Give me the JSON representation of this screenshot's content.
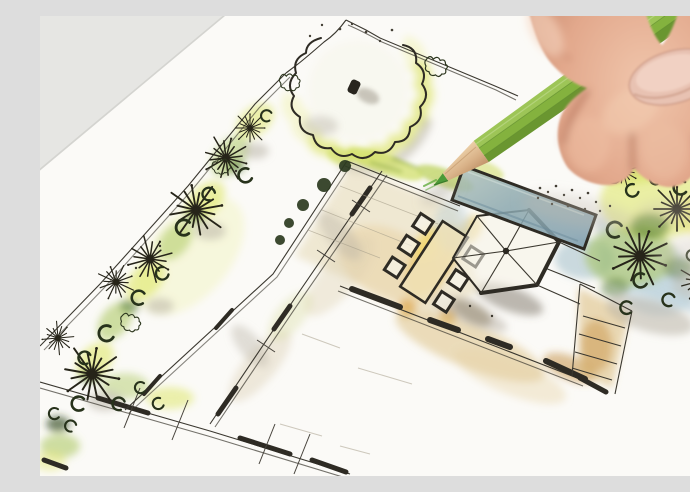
{
  "image": {
    "description": "Close-up photograph of a landscape architect's hand holding a green colored pencil over a hand-sketched garden landscape plan with ink lines and watercolor washes",
    "scene": "garden-plan-sketch-with-hand-and-pencil",
    "objects": {
      "plan_sheet": "white drawing paper with garden plan rotated diagonally",
      "tree_canopy": "large scalloped round tree crown with dark trunk dot",
      "left_planting_strip": "diagonal planting bed with starburst plants and shrub scribbles",
      "dining_terrace": "beige paved terrace with rectangular table and six chairs",
      "pavilion": "hexagonal pavilion roof with radial spokes",
      "pool": "rectangular water basin with teal-blue wash",
      "right_planting_bed": "dense planting with starburst trees, crescents and blue water wash",
      "paths_walls": "double-line garden walls with thick wall segments, tick marks and stepped walkways",
      "pencil": "green hexagonal colored pencil with sharpened wooden tip",
      "hand": "right hand gripping pencil, thumb nail visible, fingertips resting on plan"
    }
  },
  "palette": {
    "bg": "#e9e9e7",
    "paper": "#fbfaf7",
    "ink": "#2e2b24",
    "wash_yellow_green": "#dce55f",
    "wash_green": "#9fc04a",
    "wash_dark_green": "#3f6b26",
    "wash_blue": "#aec8d6",
    "pool_teal": "#8aa7ae",
    "wash_tan": "#d8b66e",
    "wash_beige": "#e6d9b5",
    "wash_yellow": "#eac463",
    "wash_orange": "#dc9e33",
    "wash_gray": "#b5afa2",
    "pencil_green": "#84b23e",
    "pencil_green_light": "#9dc557",
    "pencil_green_dark": "#6a9630",
    "pencil_wood": "#d9b288",
    "pencil_lead": "#4c9a38",
    "skin": "#e2a88c",
    "skin_light": "#f0c6ac",
    "skin_shadow": "#b07a5f",
    "nail": "#e8c2b2"
  }
}
